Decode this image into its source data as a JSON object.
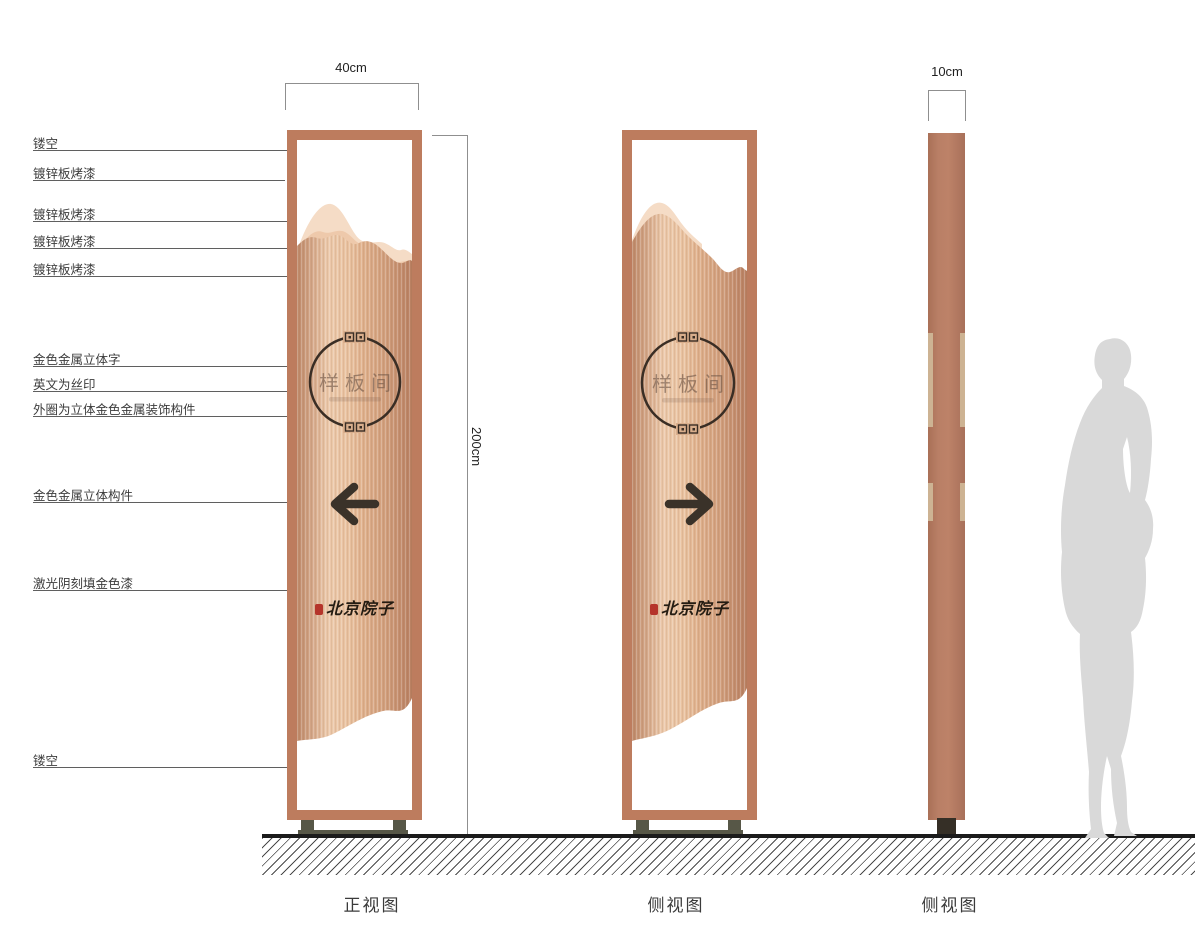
{
  "callouts": [
    {
      "text": "镂空"
    },
    {
      "text": "镀锌板烤漆"
    },
    {
      "text": "镀锌板烤漆"
    },
    {
      "text": "镀锌板烤漆"
    },
    {
      "text": "镀锌板烤漆"
    },
    {
      "text": "金色金属立体字"
    },
    {
      "text": "英文为丝印"
    },
    {
      "text": "外圈为立体金色金属装饰构件"
    },
    {
      "text": "金色金属立体构件"
    },
    {
      "text": "激光阴刻填金色漆"
    },
    {
      "text": "镂空"
    }
  ],
  "dimensions": {
    "width_front": "40cm",
    "height": "200cm",
    "width_side": "10cm"
  },
  "sign": {
    "room_name": "样板间",
    "brand_name": "北京院子"
  },
  "captions": {
    "front": "正视图",
    "side1": "侧视图",
    "side2": "侧视图"
  },
  "colors": {
    "frame_copper": "#bd7c5e",
    "panel_light": "#ecc9ab",
    "mountain_back": "#f5dcc6",
    "arrow_dark": "#3a3229",
    "base_olive": "#575747",
    "seal_red": "#b5342a",
    "silhouette_gray": "#d9d9d9"
  }
}
